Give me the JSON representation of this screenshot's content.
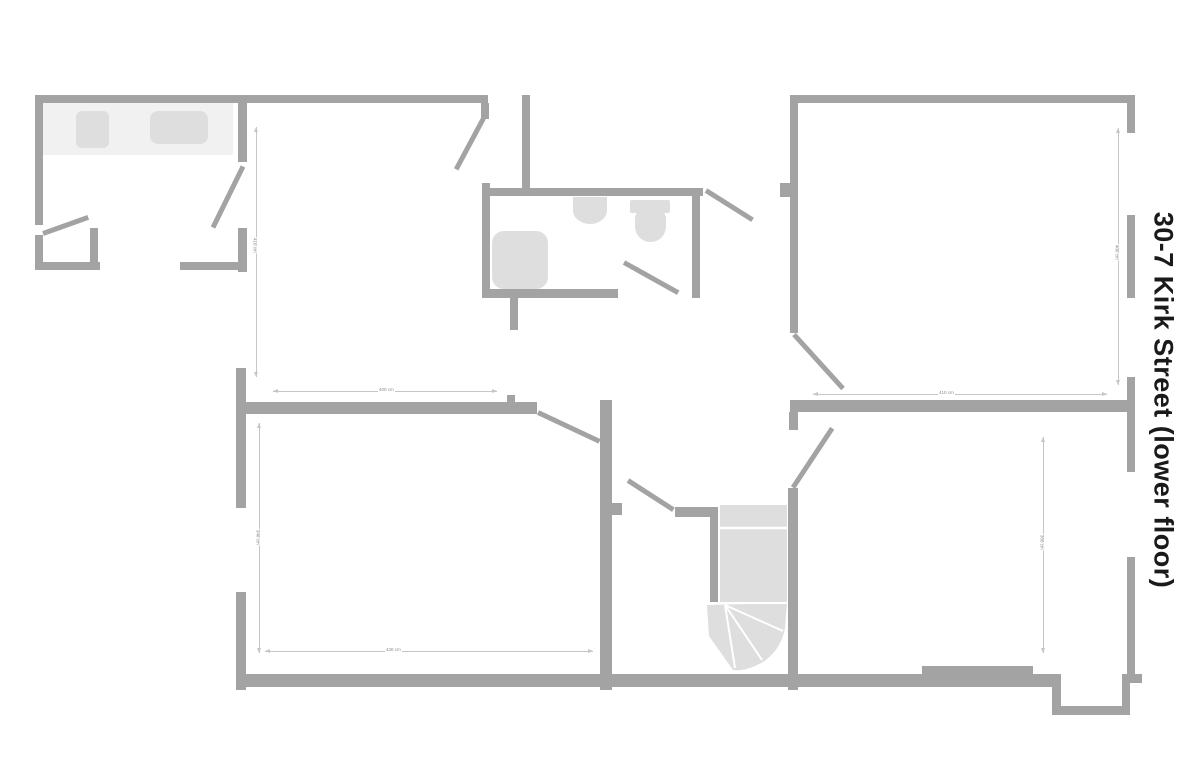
{
  "title": "30-7 Kirk Street (lower floor)",
  "colors": {
    "wall": "#a3a3a3",
    "fixture": "#dedede",
    "counter": "#f1f1f1",
    "dimension": "#c6c6c6",
    "title": "#1a1a1a"
  },
  "dims": {
    "room_top_left_height": "410 cm",
    "room_top_left_width": "400 cm",
    "room_top_right_height": "400 cm",
    "room_top_right_width": "410 cm",
    "room_bottom_left_height": "340 cm",
    "room_bottom_left_width": "430 cm",
    "room_bottom_right_height": "380 cm"
  },
  "fixtures": [
    "kitchen-counter",
    "cooktop",
    "kitchen-appliance",
    "shower",
    "washbasin",
    "toilet",
    "staircase"
  ]
}
